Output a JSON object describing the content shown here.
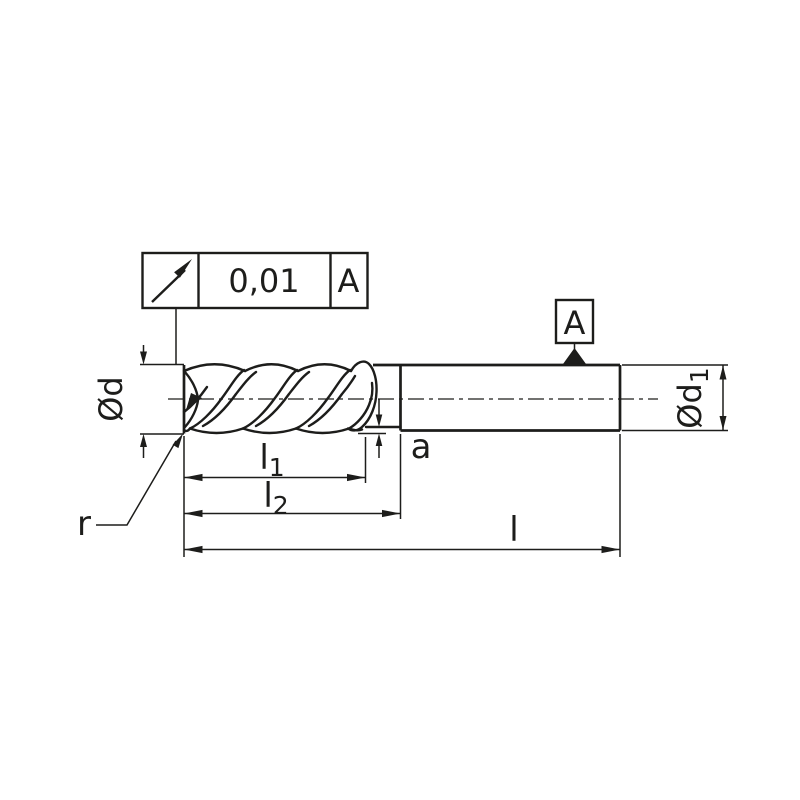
{
  "colors": {
    "ink": "#1d1d1b",
    "background": "#ffffff"
  },
  "tolerance_frame": {
    "symbol_icon": "circular-runout",
    "value": "0,01",
    "datum_ref": "A"
  },
  "datum_flag": {
    "letter": "A"
  },
  "dimensions": {
    "d": {
      "main": "Ød"
    },
    "d1": {
      "main": "Ød",
      "sub": "1"
    },
    "l1": {
      "main": "l",
      "sub": "1"
    },
    "l2": {
      "main": "l",
      "sub": "2"
    },
    "l": {
      "main": "l"
    },
    "a": {
      "main": "a"
    },
    "r": {
      "main": "r"
    }
  }
}
